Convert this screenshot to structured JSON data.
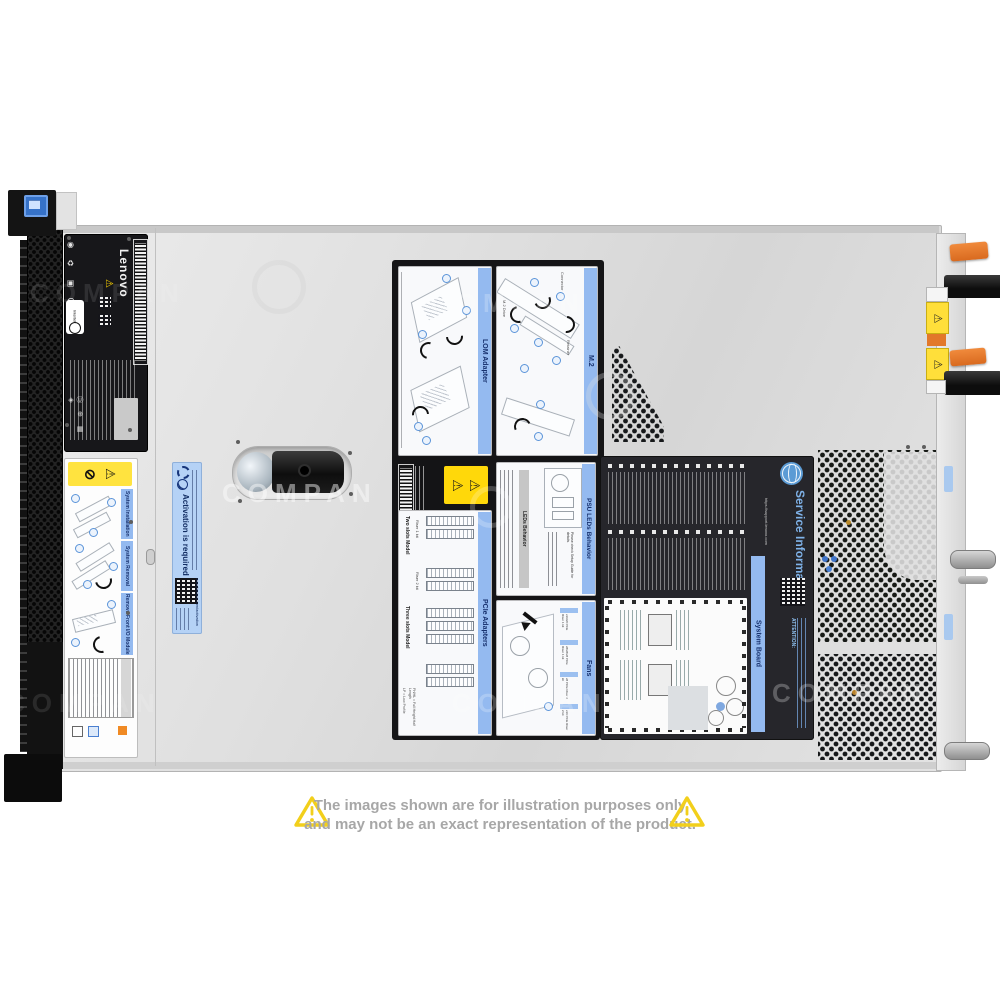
{
  "colors": {
    "accent_blue_strip": "#94baf0",
    "warning_yellow": "#ffd90a",
    "psu_orange": "#e8762a",
    "disclaimer_gray": "#a7a7a7",
    "service_info_blue": "#7fb2e8"
  },
  "icons": {
    "warning_triangle": "⚠",
    "no_lift": "⊘",
    "cert_row": "◉ ♻ ▣ CE ⚠",
    "cert_row2": "Ⓤ ⊕ ▦ ◈"
  },
  "watermark": {
    "text": "COMPAN"
  },
  "disclaimer": {
    "line1": "The images shown are for illustration purposes only",
    "line2": "and may not be an exact representation of the product."
  },
  "labels": {
    "brand": {
      "name": "Lenovo",
      "cert_badge": "Intertek"
    },
    "install": {
      "s1": "System Installation",
      "s2": "System Removal",
      "s3": "Remove Front I/O Module"
    },
    "activation": {
      "title": "Activation is required",
      "url": "www.lenovo.com/activation"
    },
    "service_info": {
      "title": "Service Information",
      "url": "https://support.lenovo.com",
      "board": "System Board",
      "attention": "ATTENTION:"
    }
  },
  "cards": {
    "lom": {
      "title": "LOM Adapter"
    },
    "m2": {
      "title": "M.2",
      "c1": "M.2 Drive",
      "c2": "Retainer",
      "c3": "Connector"
    },
    "psu": {
      "title": "PSU LEDs Behavior",
      "header": "LEDs Behavior",
      "note": "Please check Setup Guide for details."
    },
    "pcie": {
      "title": "PCIe Adapters",
      "g1": "Two slots Model",
      "g2": "Three slots Model",
      "r1": "Riser 1 kit",
      "r2": "Riser 2 kit",
      "fn1": "LP = Low Profile",
      "fn2": "FH/HL = Full Height Half Length"
    },
    "fans": {
      "title": "Fans",
      "k1": "x16/x8 PCIe Riser 1 kit",
      "k2": "x8/x8/x8 PCIe Riser 1 kit",
      "k3": "x8 PCIe Riser 2 kit",
      "k4": "x16 PCIe Riser 2 kit"
    }
  }
}
